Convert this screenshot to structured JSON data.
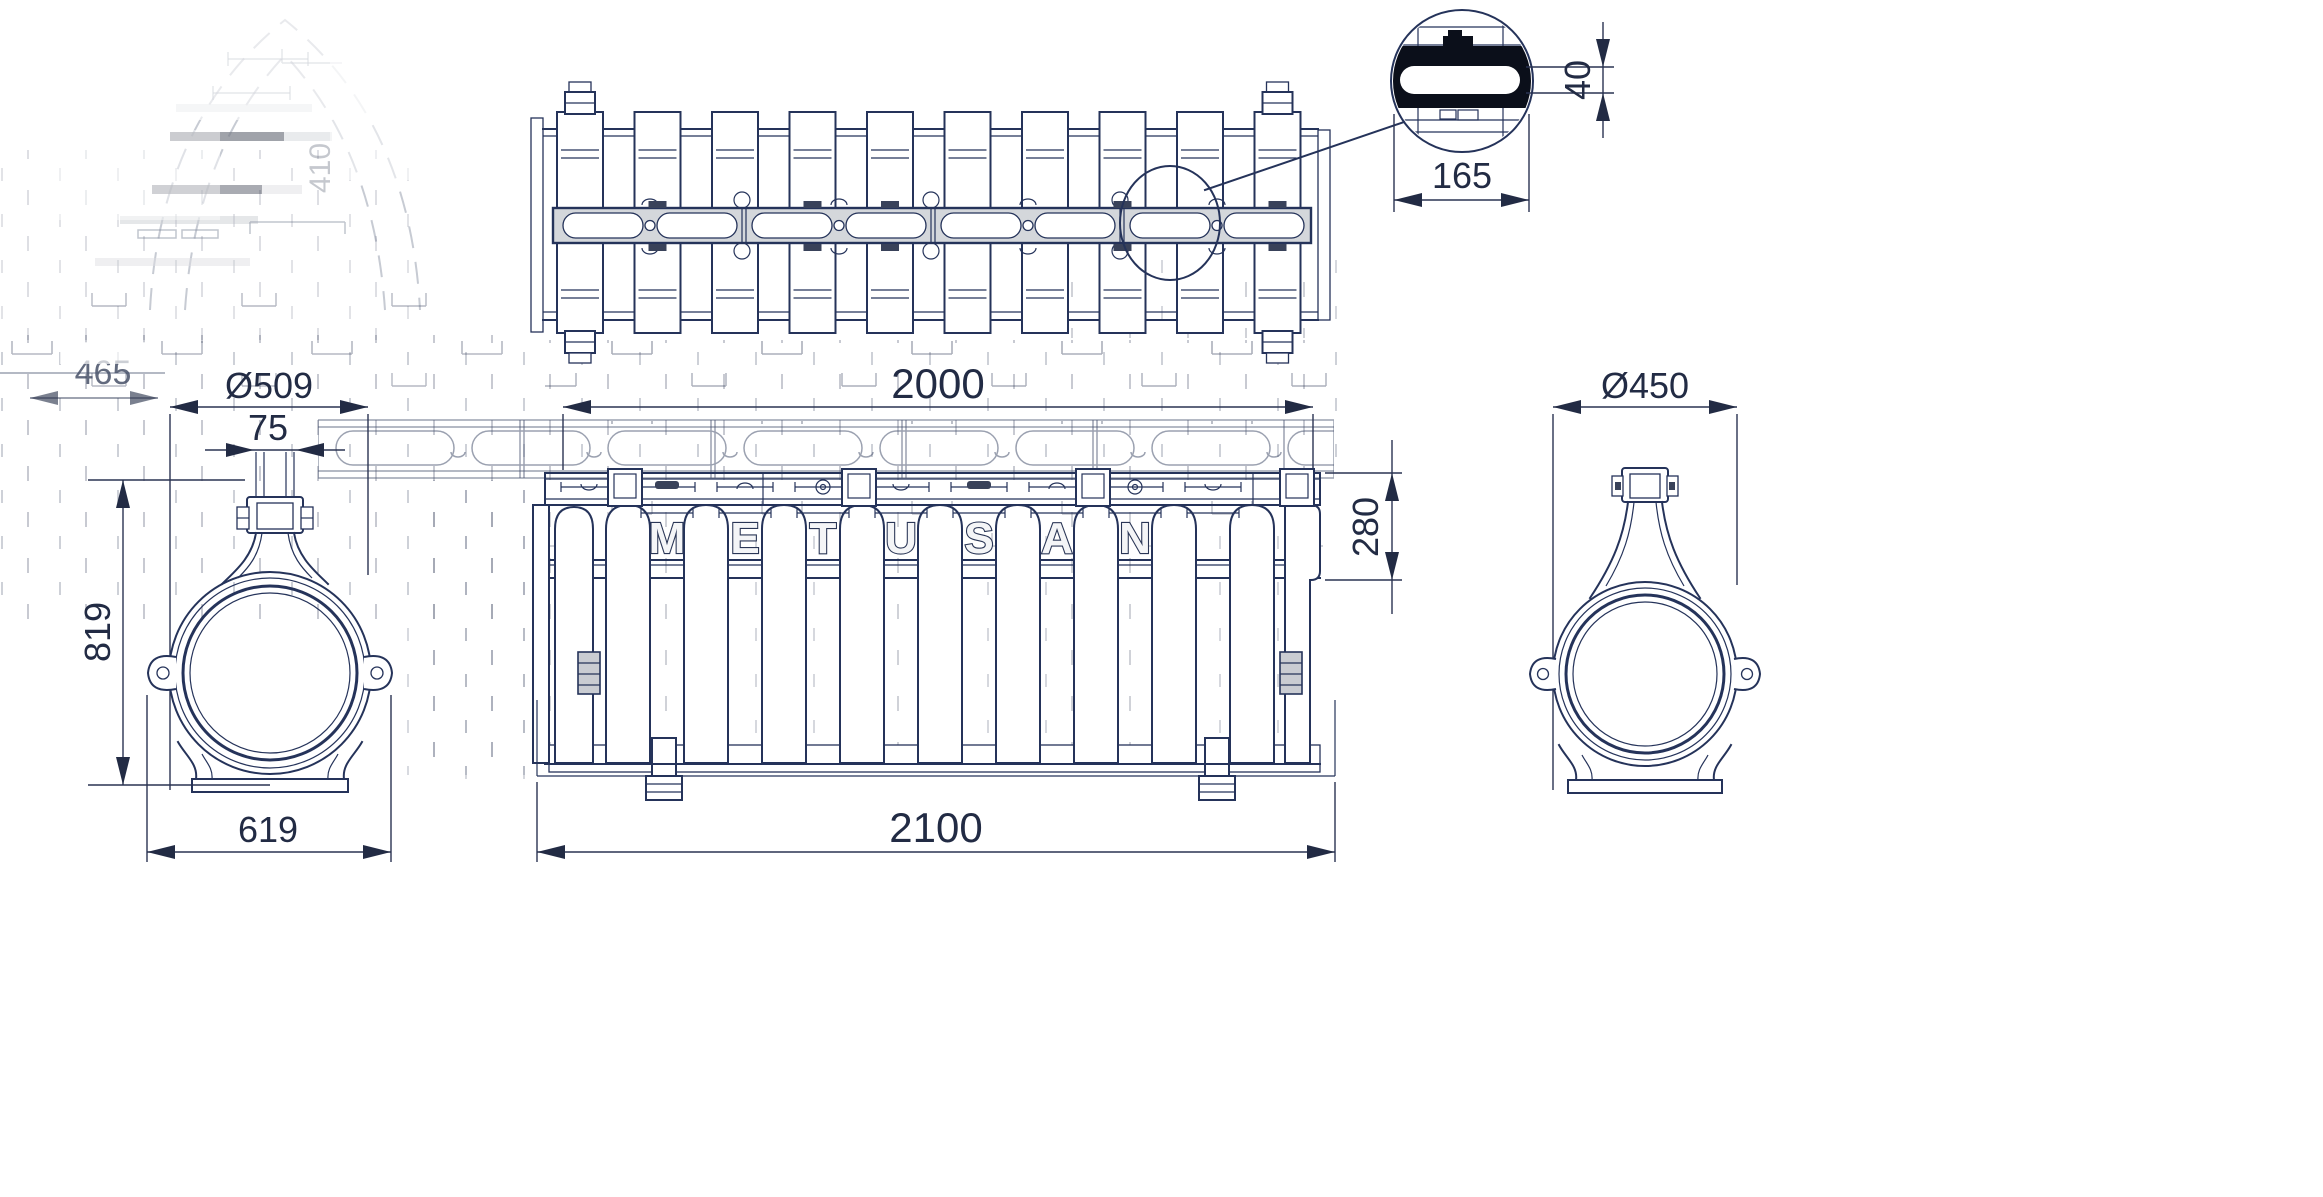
{
  "drawing": {
    "type": "technical-drawing",
    "brand": [
      "M",
      "E",
      "T",
      "U",
      "S",
      "A",
      "N"
    ],
    "views": {
      "detail": {
        "slot_width": "165",
        "slot_height": "40"
      },
      "front": {
        "grate_length": "2000",
        "end_height": "280",
        "overall_length": "2100"
      },
      "left_end": {
        "diameter": "Ø509",
        "neck_width": "75",
        "overall_height": "819",
        "base_width": "619"
      },
      "right_end": {
        "diameter": "Ø450"
      }
    },
    "ghost": {
      "width": "465",
      "height": "410"
    },
    "colors": {
      "line": "#25335a",
      "dim_text": "#222b44",
      "band_fill": "#d4d7db",
      "detail_black": "#0b0f1a",
      "ghost_line": "#4a5571",
      "background": "#ffffff"
    }
  }
}
